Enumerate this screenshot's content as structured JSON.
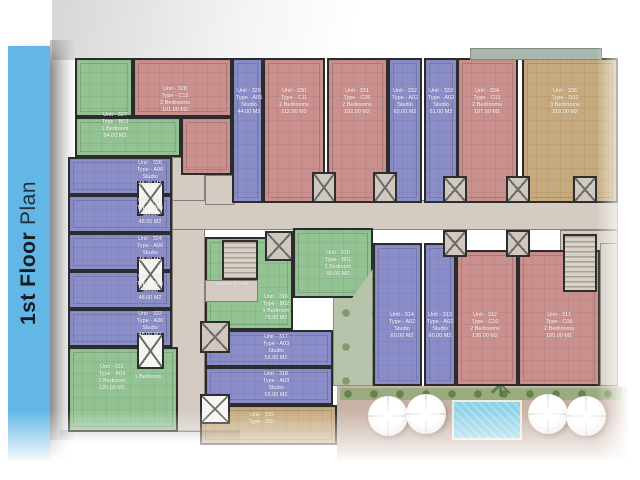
{
  "sidebar": {
    "title_bold": "1st Floor",
    "title_regular": "Plan"
  },
  "palette": {
    "sidebar_blue": "#63b7e6",
    "studio_blue": "#8b8dc8",
    "one_bedroom_green": "#93c393",
    "two_bedroom_red": "#c9908d",
    "three_bedroom_tan": "#c6aa7e",
    "corridor_tan": "#d4ccc3",
    "pool_water": "#8ed2e6"
  },
  "plan": {
    "labels": {
      "service_room": "Service Room",
      "one_bedroom_extra": "1 Bedroom"
    },
    "units": [
      {
        "id": "327",
        "unit": "Unit - 327",
        "type": "Type - B03",
        "desc": "1 Bedroom",
        "area": "94.00 M2"
      },
      {
        "id": "328",
        "unit": "Unit - 328",
        "type": "Type - C12",
        "desc": "2 Bedrooms",
        "area": "101.00 M2"
      },
      {
        "id": "329",
        "unit": "Unit - 329",
        "type": "Type - A05",
        "desc": "Studio",
        "area": "44.00 M2"
      },
      {
        "id": "330",
        "unit": "Unit - 330",
        "type": "Type - C11",
        "desc": "2 Bedrooms",
        "area": "112.00 M2"
      },
      {
        "id": "331",
        "unit": "Unit - 331",
        "type": "Type - C05",
        "desc": "2 Bedrooms",
        "area": "102.00 M2"
      },
      {
        "id": "332",
        "unit": "Unit - 332",
        "type": "Type - A02",
        "desc": "Studio",
        "area": "60.00 M2"
      },
      {
        "id": "333",
        "unit": "Unit - 333",
        "type": "Type - A02",
        "desc": "Studio",
        "area": "61.00 M2"
      },
      {
        "id": "334",
        "unit": "Unit - 334",
        "type": "Type - C03",
        "desc": "2 Bedrooms",
        "area": "107.00 M2"
      },
      {
        "id": "336",
        "unit": "Unit - 336",
        "type": "Type - D02",
        "desc": "3 Bedrooms",
        "area": "218.00 M2"
      },
      {
        "id": "326",
        "unit": "Unit - 326",
        "type": "Type - A06",
        "desc": "Studio",
        "area": "48.00 M2"
      },
      {
        "id": "325",
        "unit": "Unit - 325",
        "type": "Type - A06",
        "desc": "Studio",
        "area": "48.00 M2"
      },
      {
        "id": "324",
        "unit": "Unit - 324",
        "type": "Type - A06",
        "desc": "Studio",
        "area": "48.00 M2"
      },
      {
        "id": "323",
        "unit": "Unit - 323",
        "type": "Type - A06",
        "desc": "Studio",
        "area": "48.00 M2"
      },
      {
        "id": "322",
        "unit": "Unit - 322",
        "type": "Type - A06",
        "desc": "Studio",
        "area": "48.00 M2"
      },
      {
        "id": "321",
        "unit": "Unit - 321",
        "type": "Type - B04",
        "desc": "1 Bedroom",
        "area": "120.00 M2"
      },
      {
        "id": "316",
        "unit": "Unit - 316",
        "type": "Type - B02",
        "desc": "1 Bedroom",
        "area": "78.00 M2"
      },
      {
        "id": "315",
        "unit": "Unit - 315",
        "type": "Type - B01",
        "desc": "1 Bedroom",
        "area": "66.00 M2"
      },
      {
        "id": "317",
        "unit": "Unit - 317",
        "type": "Type - A03",
        "desc": "Studio",
        "area": "55.00 M2"
      },
      {
        "id": "318",
        "unit": "Unit - 318",
        "type": "Type - A03",
        "desc": "Studio",
        "area": "55.00 M2"
      },
      {
        "id": "319",
        "unit": "Unit - 319",
        "type": "Type - D01",
        "desc": "",
        "area": ""
      },
      {
        "id": "314",
        "unit": "Unit - 314",
        "type": "Type - A02",
        "desc": "Studio",
        "area": "60.00 M2"
      },
      {
        "id": "313",
        "unit": "Unit - 313",
        "type": "Type - A02",
        "desc": "Studio",
        "area": "60.00 M2"
      },
      {
        "id": "312",
        "unit": "Unit - 312",
        "type": "Type - C10",
        "desc": "2 Bedrooms",
        "area": "136.00 M2"
      },
      {
        "id": "311",
        "unit": "Unit - 311",
        "type": "Type - C09",
        "desc": "2 Bedrooms",
        "area": "105.00 M2"
      }
    ]
  }
}
